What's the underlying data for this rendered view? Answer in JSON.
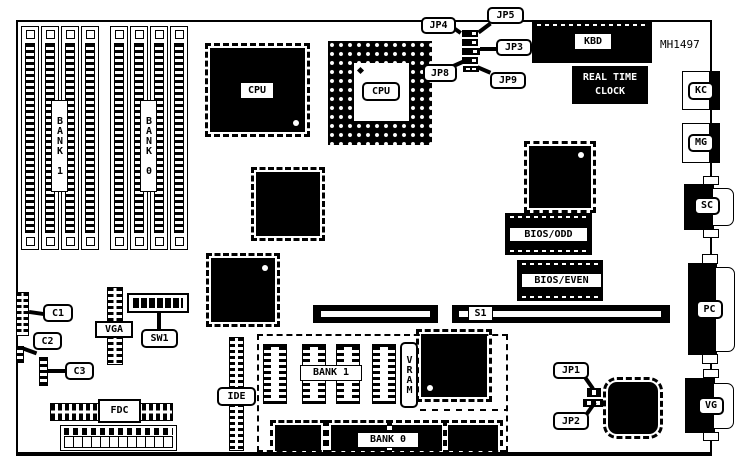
{
  "colors": {
    "ink": "#000000",
    "paper": "#ffffff"
  },
  "diagram": {
    "part_number": "MH1497",
    "memory": {
      "bank1_top": "BANK 1",
      "bank0_top": "BANK 0",
      "bank1_bottom": "BANK 1",
      "bank0_bottom": "BANK 0",
      "vram": "VRAM"
    },
    "cpus": {
      "qfp": "CPU",
      "pga": "CPU"
    },
    "jumpers": {
      "jp1": "JP1",
      "jp2": "JP2",
      "jp3": "JP3",
      "jp4": "JP4",
      "jp5": "JP5",
      "jp8": "JP8",
      "jp9": "JP9"
    },
    "headers": {
      "c1": "C1",
      "c2": "C2",
      "c3": "C3",
      "vga": "VGA",
      "fdc": "FDC",
      "ide": "IDE",
      "s1": "S1"
    },
    "switch_sw1": "SW1",
    "chips": {
      "rtc_line1": "REAL TIME",
      "rtc_line2": "CLOCK",
      "bios_odd": "BIOS/ODD",
      "bios_even": "BIOS/EVEN"
    },
    "rear_connectors": {
      "kbd": "KBD",
      "kc": "KC",
      "mg": "MG",
      "sc": "SC",
      "pc": "PC",
      "vg": "VG"
    }
  }
}
